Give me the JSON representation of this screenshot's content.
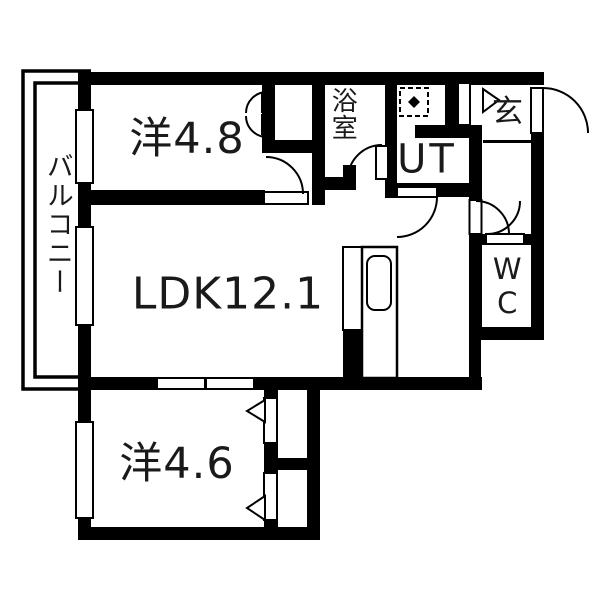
{
  "floorplan": {
    "type": "apartment-floorplan",
    "colors": {
      "wall": "#000000",
      "background": "#ffffff",
      "text": "#1a1a1a"
    },
    "rooms": {
      "balcony": {
        "label": "バルコニー"
      },
      "bedroom1": {
        "label": "洋4.8"
      },
      "ldk": {
        "label": "LDK12.1"
      },
      "bedroom2": {
        "label": "洋4.6"
      },
      "bath": {
        "label": "浴室"
      },
      "utility": {
        "label": "UT"
      },
      "entrance": {
        "label": "玄"
      },
      "toilet": {
        "label": "WC"
      }
    },
    "features": [
      "balcony-rail",
      "windows-x3",
      "entry-door-swing",
      "bath-door-swing",
      "ut-door-swing",
      "ldk-hall-door-swing",
      "wc-door-swing",
      "closet-double-door",
      "sliding-door",
      "kitchen-counter-with-sink",
      "washing-machine-space"
    ]
  }
}
